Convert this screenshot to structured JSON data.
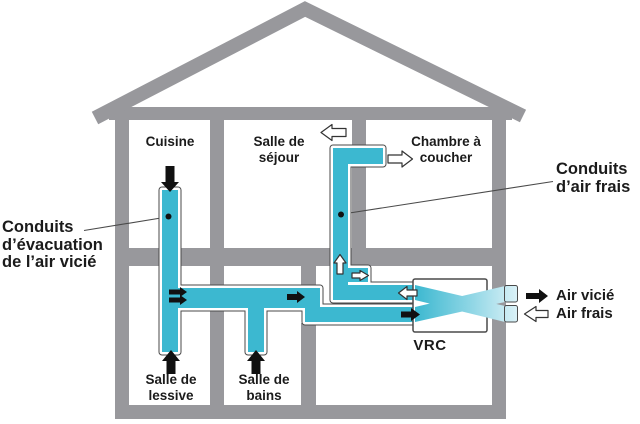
{
  "titles": {
    "exhaust": {
      "lines": [
        "Conduits",
        "d’évacuation",
        "de l’air vicié"
      ]
    },
    "fresh": {
      "lines": [
        "Conduits",
        "d’air frais"
      ]
    }
  },
  "rooms": {
    "cuisine": {
      "lines": [
        "Cuisine"
      ]
    },
    "sejour": {
      "lines": [
        "Salle de",
        "séjour"
      ]
    },
    "chambre": {
      "lines": [
        "Chambre à",
        "coucher"
      ]
    },
    "lessive": {
      "lines": [
        "Salle de",
        "lessive"
      ]
    },
    "bains": {
      "lines": [
        "Salle de",
        "bains"
      ]
    }
  },
  "unit": {
    "label": "VRC"
  },
  "legend": {
    "stale": "Air vicié",
    "fresh": "Air frais"
  },
  "colors": {
    "wall": "#98989c",
    "duct": "#3cb8d0",
    "duct_pale": "#daf1f7",
    "outline": "#4a4a4a",
    "text": "#1b1b1b"
  }
}
